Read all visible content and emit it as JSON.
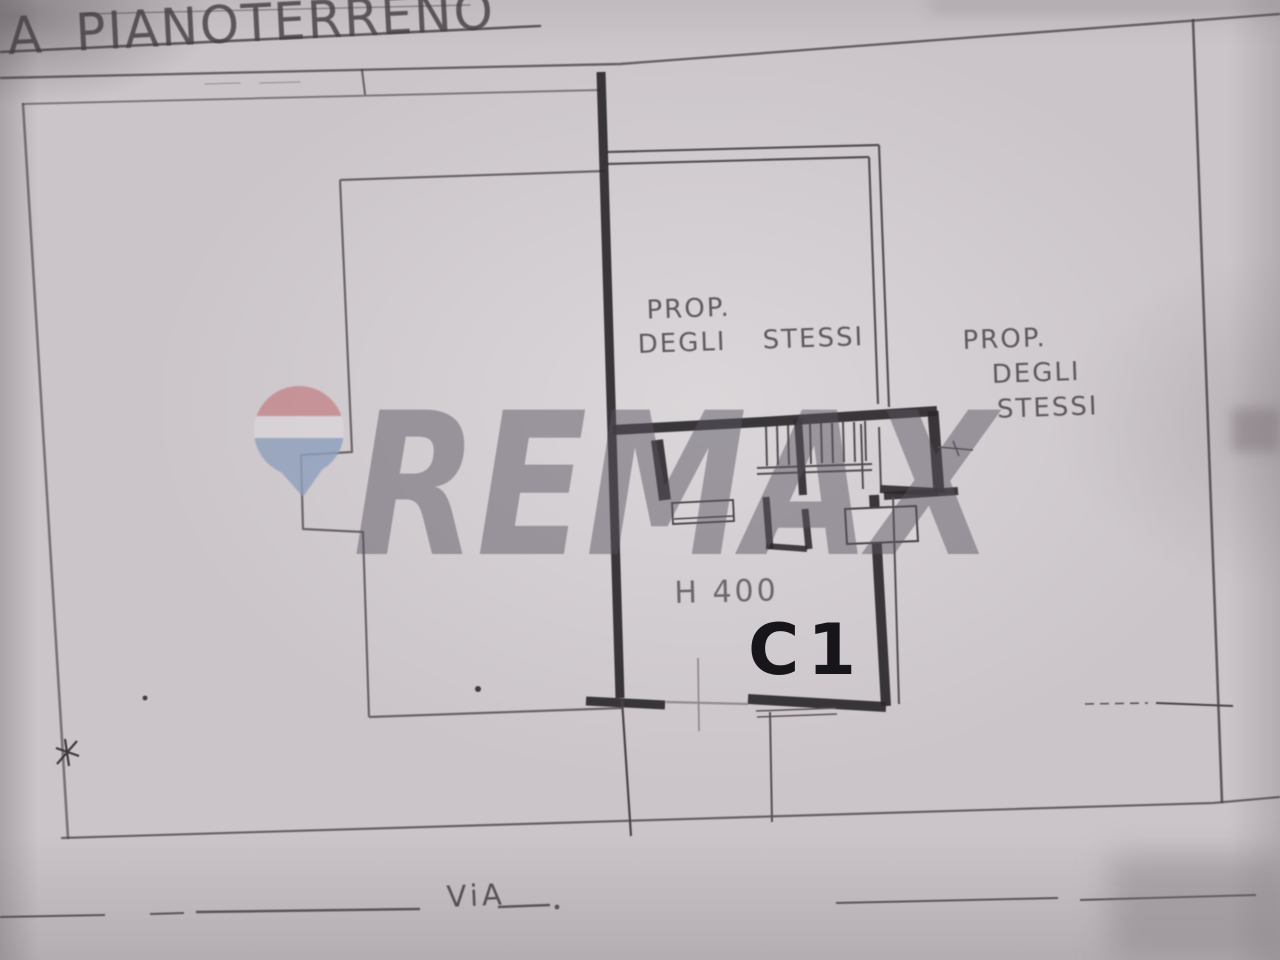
{
  "document": {
    "title": "A PIANOTERRENO",
    "street_label": "ViA",
    "unit_label": "C1",
    "height_note": "H 400",
    "property_note_left": {
      "line1": "PROP.",
      "line2": "DEGLI STESSI"
    },
    "property_note_right": {
      "line1": "PROP.",
      "line2": "DEGLI",
      "line3": "STESSI"
    }
  },
  "watermark": {
    "brand": "REMAX",
    "balloon_icon": "remax-hot-air-balloon"
  },
  "colors": {
    "paper": "#cbc5c9",
    "paper_light": "#d9d4d7",
    "ink": "#453f44",
    "wall": "#2b282b",
    "label_ink": "#17151a",
    "watermark_gray": "#5a5460",
    "balloon_red": "#c4878d",
    "balloon_white": "#dad5d8",
    "balloon_blue": "#8fa0bd"
  }
}
